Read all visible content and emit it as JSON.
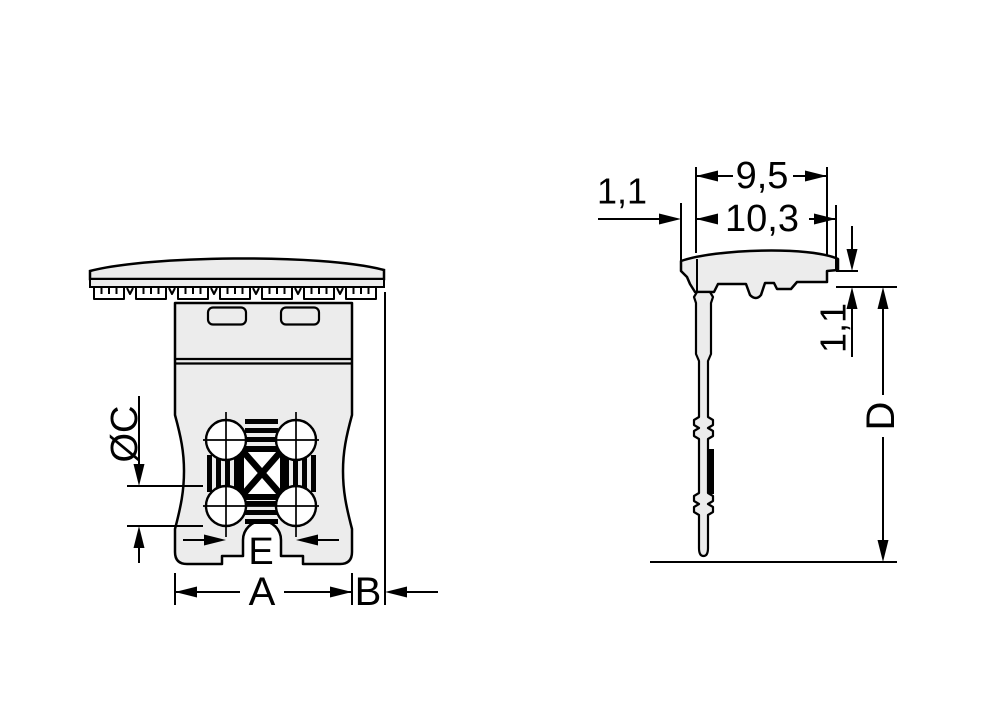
{
  "colors": {
    "background": "#ffffff",
    "part_fill": "#ececec",
    "outline": "#000000",
    "detail_black": "#000000",
    "hole_fill": "#ffffff"
  },
  "front_view": {
    "labels": {
      "hole_diameter": "ØC",
      "pole_pitch": "E",
      "housing_width": "A",
      "overhang": "B"
    }
  },
  "side_view": {
    "labels": {
      "top_width": "9,5",
      "total_width": "10,3",
      "lip_offset": "1,1",
      "standoff_height": "1,1",
      "depth": "D"
    }
  }
}
